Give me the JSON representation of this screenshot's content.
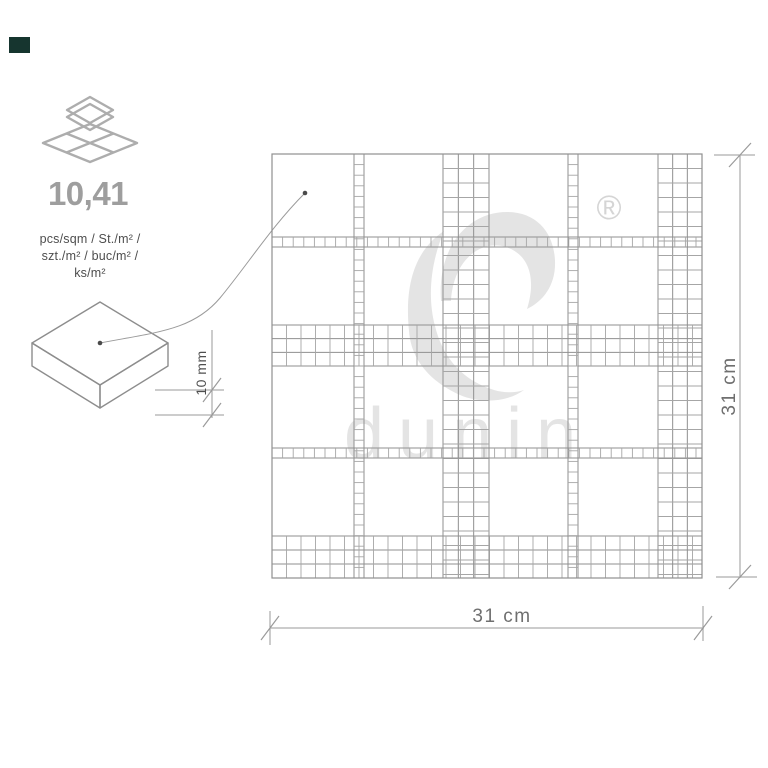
{
  "swatch": {
    "color": "#16352f"
  },
  "spec": {
    "coverage_value": "10,41",
    "units_line1": "pcs/sqm / St./m² /",
    "units_line2": "szt./m² / buc/m² /",
    "units_line3": "ks/m²",
    "thickness": "10 mm"
  },
  "dimensions": {
    "width": "31 cm",
    "height": "31 cm"
  },
  "watermark": {
    "brand": "dunin",
    "registered": "®"
  },
  "icons": {
    "tiles_icon": "three-overlapping-diamond-tiles",
    "registered_icon": "®"
  },
  "colors": {
    "grid_edge": "#8f8f8f",
    "grid_cell": "#a6a6a6",
    "watermark": "#e4e4e4",
    "value_text": "#9e9e9e",
    "units_text": "#4e4e4e",
    "dim_text": "#6f6f6f",
    "slab_left": "#cbcbcb",
    "slab_right": "#c3c3c3",
    "swatch": "#16352f"
  },
  "mosaic": {
    "x": 272,
    "y": 154,
    "w": 430,
    "h": 424,
    "v_ladders": [
      354,
      568
    ],
    "h_ladders": [
      237,
      448
    ],
    "ladder_w": 10,
    "ladder_cell": 10.6,
    "v_bands": [
      [
        443,
        46
      ],
      [
        658,
        44
      ]
    ],
    "h_bands": [
      [
        325,
        41
      ],
      [
        536,
        42
      ]
    ],
    "band_cell": 14.5
  }
}
